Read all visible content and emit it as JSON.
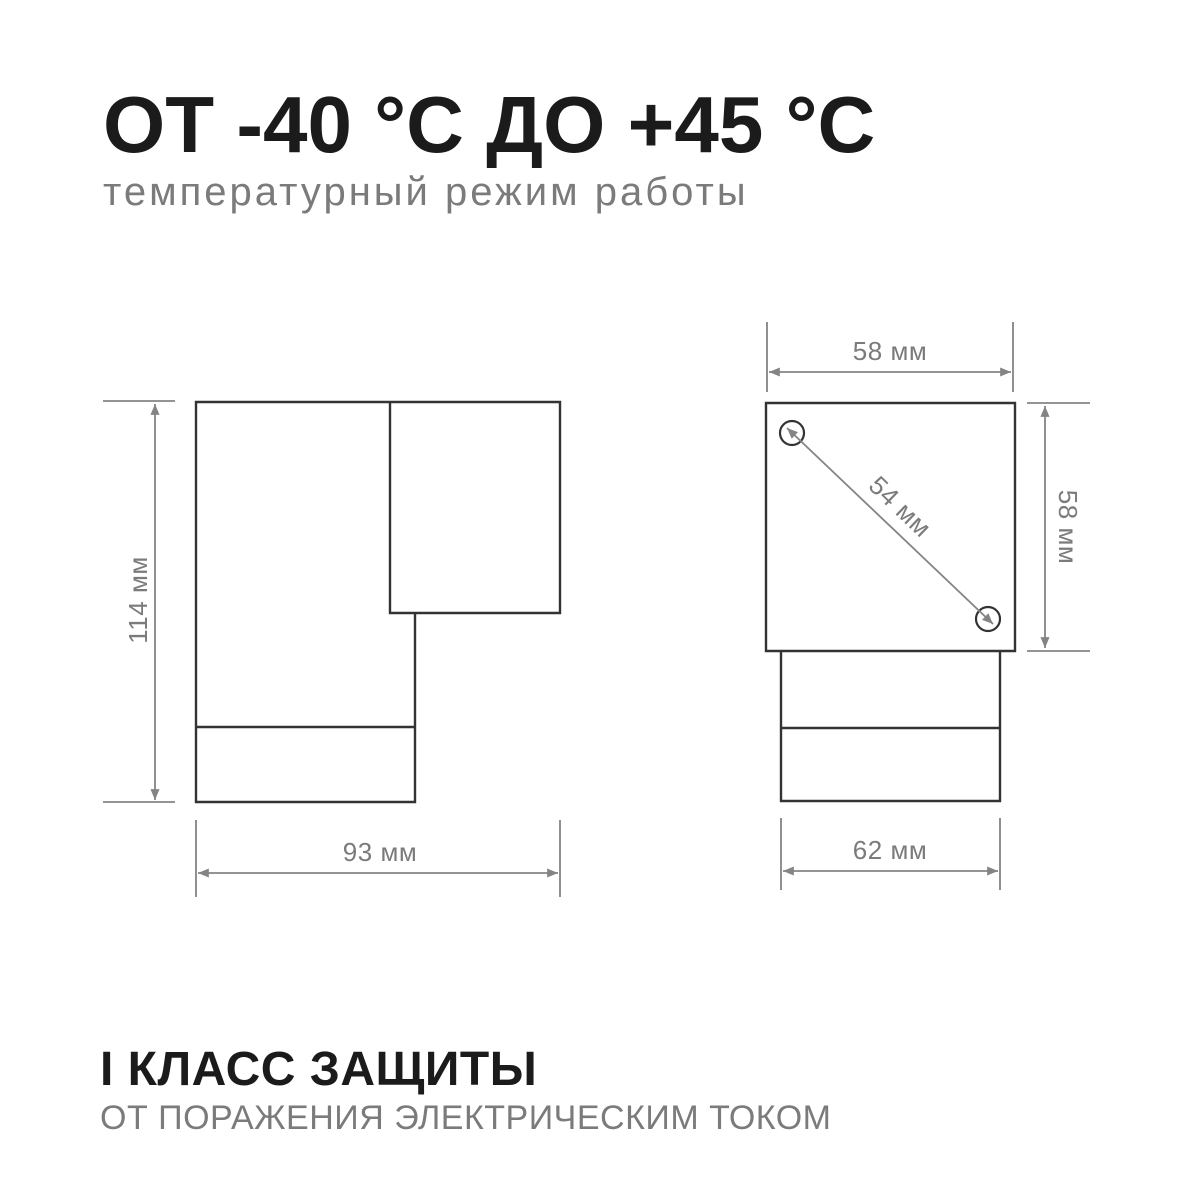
{
  "page": {
    "background": "#ffffff"
  },
  "colors": {
    "heading": "#1b1b1b",
    "muted": "#7b7b7b",
    "outline": "#333333",
    "dimension": "#848484"
  },
  "header": {
    "title": "ОТ -40 °С ДО +45 °С",
    "subtitle": "температурный режим работы"
  },
  "footer": {
    "title": "I КЛАСС ЗАЩИТЫ",
    "subtitle": "ОТ ПОРАЖЕНИЯ ЭЛЕКТРИЧЕСКИМ ТОКОМ"
  },
  "diagrams": {
    "side_view": {
      "height_label": "114 мм",
      "width_label": "93 мм"
    },
    "front_view": {
      "top_width_label": "58 мм",
      "height_label": "58 мм",
      "diagonal_label": "54 мм",
      "base_width_label": "62 мм"
    }
  }
}
